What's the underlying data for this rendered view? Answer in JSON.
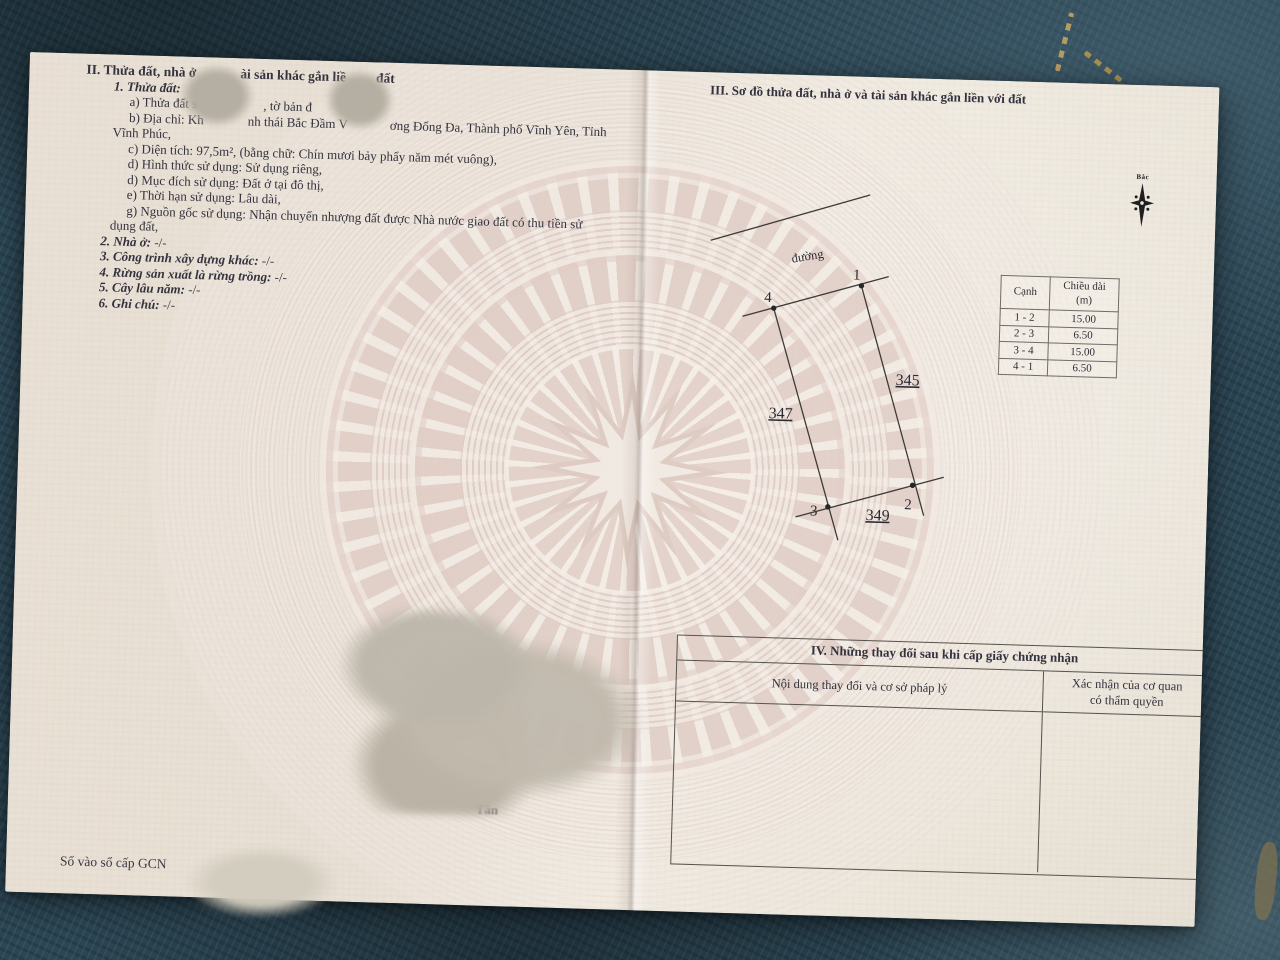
{
  "paper": {
    "left": {
      "title2": {
        "s1": "II. Thửa đất, nhà ở",
        "s2": "ài sản khác gắn liề",
        "s3": "đất"
      },
      "sub1": "1. Thửa đất:",
      "a": {
        "s1": "a) Thửa đất s",
        "s2": ", tờ bản đ"
      },
      "b": {
        "s1": "b) Địa chỉ: Kh",
        "s2": "nh thái Bắc Đầm V",
        "s3": "ơng Đống Đa, Thành phố Vĩnh Yên, Tỉnh"
      },
      "b2": "Vĩnh Phúc,",
      "c": "c) Diện tích: 97,5m², (bằng chữ: Chín mươi bảy phẩy năm mét vuông),",
      "d1": "d) Hình thức sử dụng: Sử dụng riêng,",
      "d2": "d) Mục đích sử dụng: Đất ở tại đô thị,",
      "e": "e) Thời hạn sử dụng: Lâu dài,",
      "g1": "g) Nguồn gốc sử dụng: Nhận chuyển nhượng đất được Nhà nước giao đất có thu tiền sử",
      "g2": "dụng đất,",
      "items": [
        {
          "label": "2. Nhà ở:",
          "value": "-/-"
        },
        {
          "label": "3. Công trình xây dựng khác:",
          "value": "-/-"
        },
        {
          "label": "4. Rừng sản xuất là rừng trồng:",
          "value": "-/-"
        },
        {
          "label": "5. Cây lâu năm:",
          "value": "-/-"
        },
        {
          "label": "6. Ghi chú:",
          "value": "-/-"
        }
      ],
      "footer": "Số vào sổ cấp GCN"
    },
    "right": {
      "title3": "III. Sơ đồ thửa đất, nhà ở và tài sản khác gắn liền với đất",
      "compass_label": "Bắc",
      "diagram": {
        "road_label": "đường",
        "p1": "1",
        "p2": "2",
        "p3": "3",
        "p4": "4",
        "adj_right": "345",
        "adj_left": "347",
        "adj_bottom": "349"
      },
      "edge_table": {
        "h1": "Cạnh",
        "h2a": "Chiều dài",
        "h2b": "(m)",
        "rows": [
          {
            "side": "1 - 2",
            "len": "15.00"
          },
          {
            "side": "2 - 3",
            "len": "6.50"
          },
          {
            "side": "3 - 4",
            "len": "15.00"
          },
          {
            "side": "4 - 1",
            "len": "6.50"
          }
        ]
      },
      "table4": {
        "title": "IV. Những thay đổi sau khi cấp giấy chứng nhận",
        "col1": "Nội dung thay đổi và cơ sở pháp lý",
        "col2a": "Xác nhận của cơ quan",
        "col2b": "có thẩm quyền"
      },
      "stamp_fragment": "Tân"
    }
  }
}
